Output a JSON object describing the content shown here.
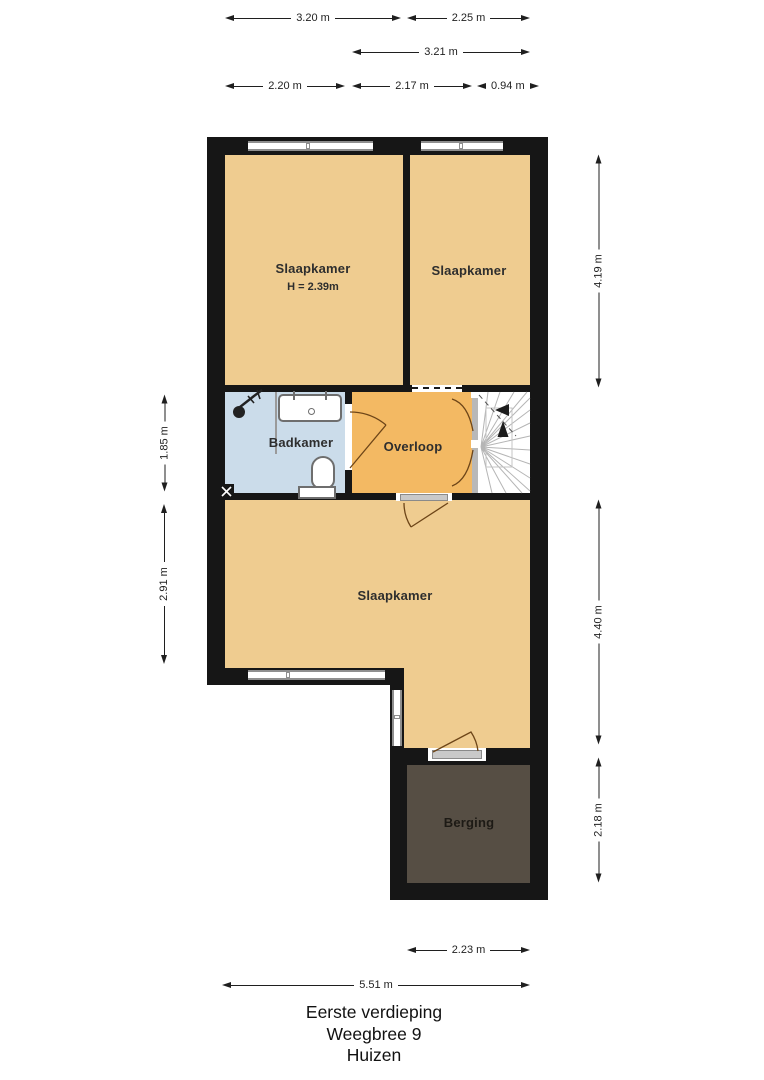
{
  "title_block": {
    "line1": "Eerste verdieping",
    "line2": "Weegbree 9",
    "line3": "Huizen"
  },
  "rooms": {
    "slaapkamer1": {
      "label": "Slaapkamer",
      "height_note": "H = 2.39m"
    },
    "slaapkamer2": {
      "label": "Slaapkamer"
    },
    "badkamer": {
      "label": "Badkamer"
    },
    "overloop": {
      "label": "Overloop"
    },
    "slaapkamer3": {
      "label": "Slaapkamer"
    },
    "berging": {
      "label": "Berging"
    }
  },
  "dimensions": {
    "top_row1": [
      "3.20 m",
      "2.25 m"
    ],
    "top_row2": [
      "3.21 m"
    ],
    "top_row3": [
      "2.20 m",
      "2.17 m",
      "0.94 m"
    ],
    "right": [
      "4.19 m",
      "4.40 m",
      "2.18 m"
    ],
    "left": [
      "1.85 m",
      "2.91 m"
    ],
    "bottom": [
      "2.23 m",
      "5.51 m"
    ]
  },
  "colors": {
    "wall": "#161616",
    "bedroom": "#efcc90",
    "hallway": "#f3b963",
    "bathroom": "#cbdcea",
    "storage": "#564e44",
    "dimension_text": "#1f1f1f",
    "door_arc": "#6d4518",
    "stair_tread": "#b5b5b5",
    "window_frame": "#8f8f8f",
    "fixture_outline": "#6e6e6e"
  }
}
